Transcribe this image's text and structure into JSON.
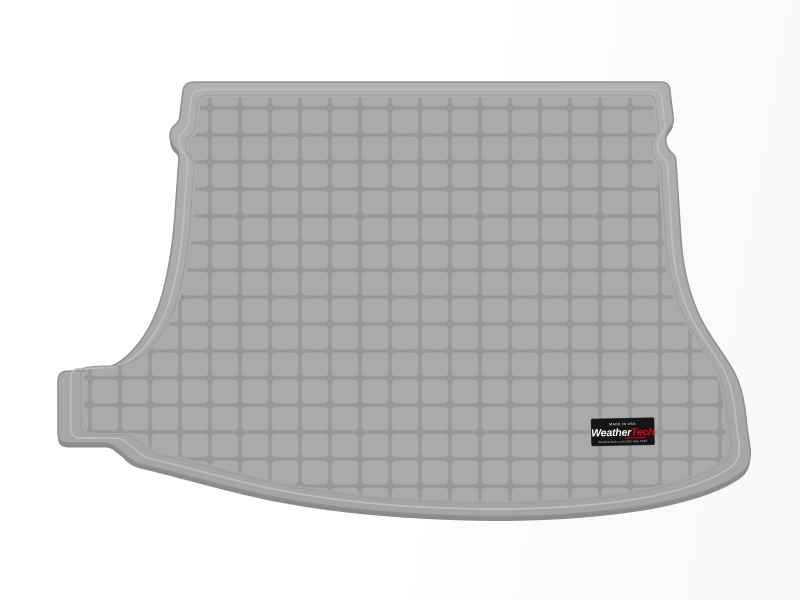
{
  "page": {
    "background_color": "#ffffff"
  },
  "product_image": {
    "label": "grey-cargo-trunk-liner-mat-top-view",
    "colors": {
      "mat_base": "#a9aba9",
      "mat_base_light": "#b0b2b0",
      "mat_base_dark": "#a2a4a2",
      "grid_line": "#979997",
      "edge_line": "#8d8f8e",
      "edge_thickness": "#8a8c8b",
      "ridge_highlight": "#bcbebc"
    },
    "badge": {
      "top_text": "MADE IN USA",
      "brand_first": "Weather",
      "brand_second": "Tech",
      "bottom_text": "weathertech.com   800-441-6287",
      "background_color": "#151515",
      "brand_first_color": "#ffffff",
      "brand_second_color": "#e8001c",
      "small_text_color": "#c9c9c9"
    }
  }
}
